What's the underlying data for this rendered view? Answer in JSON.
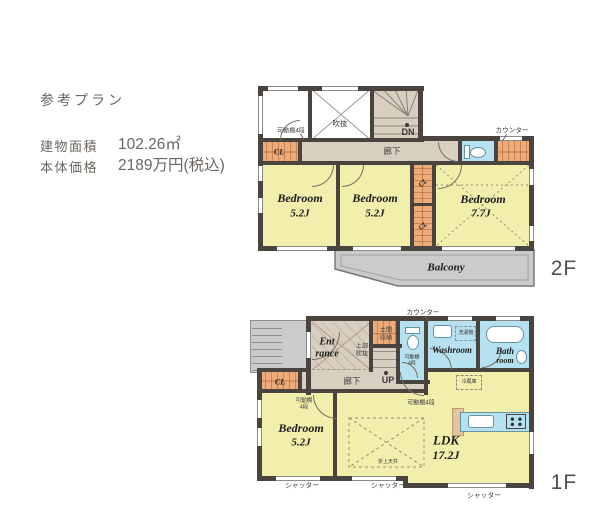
{
  "header": {
    "plan_title": "参考プラン",
    "area_label": "建物面積",
    "area_value": "102.26㎡",
    "price_label": "本体価格",
    "price_value": "2189万円(税込)"
  },
  "palette": {
    "wall": "#4a443e",
    "room_yellow": "#f2efad",
    "corridor_beige": "#d9cfc1",
    "storage_orange": "#ecab79",
    "wet_area_blue": "#b5e1f0",
    "outdoor_gray": "#cbcbcb"
  },
  "floor2": {
    "floor_label": "2F",
    "shelf_note": "可動棚4段",
    "closet_label": "CL",
    "void_label": "吹抜",
    "stairs_label": "DN",
    "hallway_label": "廊下",
    "counter_note": "カウンター",
    "bedroom1_name": "Bedroom",
    "bedroom1_size": "5.2J",
    "bedroom2_name": "Bedroom",
    "bedroom2_size": "5.2J",
    "bedroom3_name": "Bedroom",
    "bedroom3_size": "7.7J",
    "balcony_label": "Balcony"
  },
  "floor1": {
    "floor_label": "1F",
    "entrance_line1": "Ent",
    "entrance_line2": "rance",
    "doma_line1": "土間",
    "doma_line2": "収納",
    "upper_void_line1": "上部",
    "upper_void_line2": "吹抜",
    "stairs_label": "UP",
    "hallway_label": "廊下",
    "toilet_shelf_line1": "可動棚",
    "toilet_shelf_line2": "4段",
    "counter_note": "カウンター",
    "washroom_label": "Washroom",
    "washer_note": "洗濯機",
    "bath_line1": "Bath",
    "bath_line2": "room",
    "closet_label": "CL",
    "bedroom_name": "Bedroom",
    "bedroom_size": "5.2J",
    "bedroom_shelf_line1": "可動棚",
    "bedroom_shelf_line2": "4段",
    "ldk_shelf_note": "可動棚4段",
    "fridge_note": "冷蔵庫",
    "ldk_name": "LDK",
    "ldk_size": "17.2J",
    "ceiling_note": "折上天井",
    "shutter_note": "シャッター"
  }
}
